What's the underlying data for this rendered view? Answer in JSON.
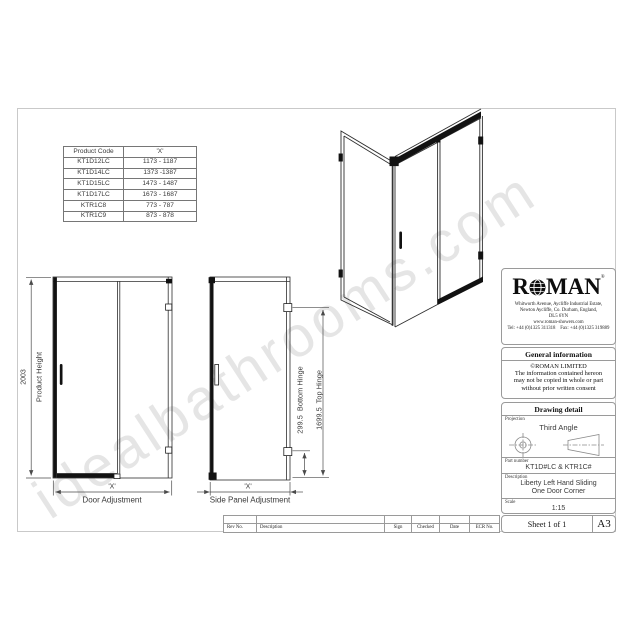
{
  "watermark": "idealbathrooms.com",
  "product_table": {
    "headers": [
      "Product Code",
      "'X'"
    ],
    "rows": [
      [
        "KT1D12LC",
        "1173 - 1187"
      ],
      [
        "KT1D14LC",
        "1373 -1387"
      ],
      [
        "KT1D15LC",
        "1473 - 1487"
      ],
      [
        "KT1D17LC",
        "1673 - 1687"
      ],
      [
        "KTR1C8",
        "773 - 787"
      ],
      [
        "KTR1C9",
        "873 - 878"
      ]
    ]
  },
  "drawing_labels": {
    "product_height_value": "2003",
    "product_height": "Product Height",
    "door_x": "'X'",
    "door_adjustment": "Door Adjustment",
    "side_x": "'X'",
    "side_panel_adjustment": "Side Panel Adjustment",
    "bottom_hinge": "299.5  Bottom Hinge",
    "top_hinge": "1699.5  Top Hinge"
  },
  "title_block": {
    "brand_r": "R",
    "brand_man": "MAN",
    "registered": "®",
    "address_lines": [
      "Whitworth Avenue, Aycliffe Industrial Estate,",
      "Newton Aycliffe, Co. Durham, England,",
      "DL5 6YN"
    ],
    "website": "www.roman-showers.com",
    "tel_fax": "Tel: +44 (0)1325 311318    Fax: +44 (0)1325 319889",
    "general_info_header": "General information",
    "general_info_lines": [
      "©ROMAN LIMITED",
      "The information contained hereon",
      "may not be copied in whole or part",
      "without prior written consent"
    ],
    "drawing_detail_header": "Drawing detail",
    "projection_label": "Projection",
    "projection_value": "Third Angle",
    "part_number_label": "Part number",
    "part_number_value": "KT1D#LC & KTR1C#",
    "description_label": "Description",
    "description_line1": "Liberty Left Hand Sliding",
    "description_line2": "One Door Corner",
    "scale_label": "Scale",
    "scale_value": "1:15",
    "sheet": "Sheet 1 of 1",
    "paper_size": "A3"
  },
  "revision_strip": {
    "columns": [
      "Rev No.",
      "Description",
      "Sign",
      "Checked",
      "Date",
      "ECR No."
    ]
  }
}
